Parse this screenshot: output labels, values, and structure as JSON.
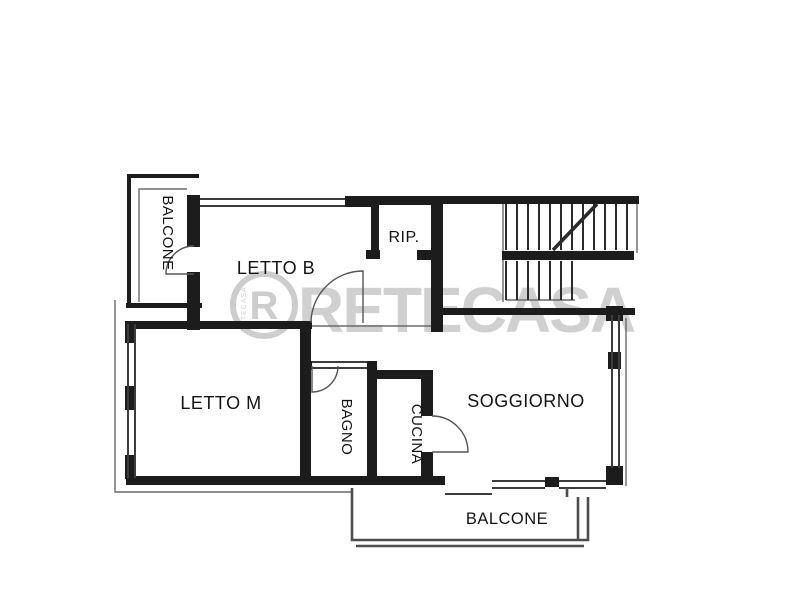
{
  "watermark": {
    "letter": "R",
    "brand": "RETECASA"
  },
  "rooms": [
    {
      "id": "balcone-top-left",
      "label": "BALCONE",
      "orientation": "vertical"
    },
    {
      "id": "letto-b",
      "label": "LETTO B",
      "orientation": "horizontal"
    },
    {
      "id": "rip",
      "label": "RIP.",
      "orientation": "horizontal"
    },
    {
      "id": "letto-m",
      "label": "LETTO M",
      "orientation": "horizontal"
    },
    {
      "id": "bagno",
      "label": "BAGNO",
      "orientation": "vertical"
    },
    {
      "id": "cucina",
      "label": "CUCINA",
      "orientation": "vertical"
    },
    {
      "id": "soggiorno",
      "label": "SOGGIORNO",
      "orientation": "horizontal"
    },
    {
      "id": "balcone-bottom",
      "label": "BALCONE",
      "orientation": "horizontal"
    }
  ],
  "colors": {
    "background": "#ffffff",
    "wall": "#1c1c1c",
    "line": "#3c3c3c",
    "thin": "#6a6a6a",
    "parapet": "#4d4d4d",
    "stair": "#2a2a2a",
    "door": "#555555",
    "watermark": "#cdcdcd",
    "label": "#141414"
  }
}
